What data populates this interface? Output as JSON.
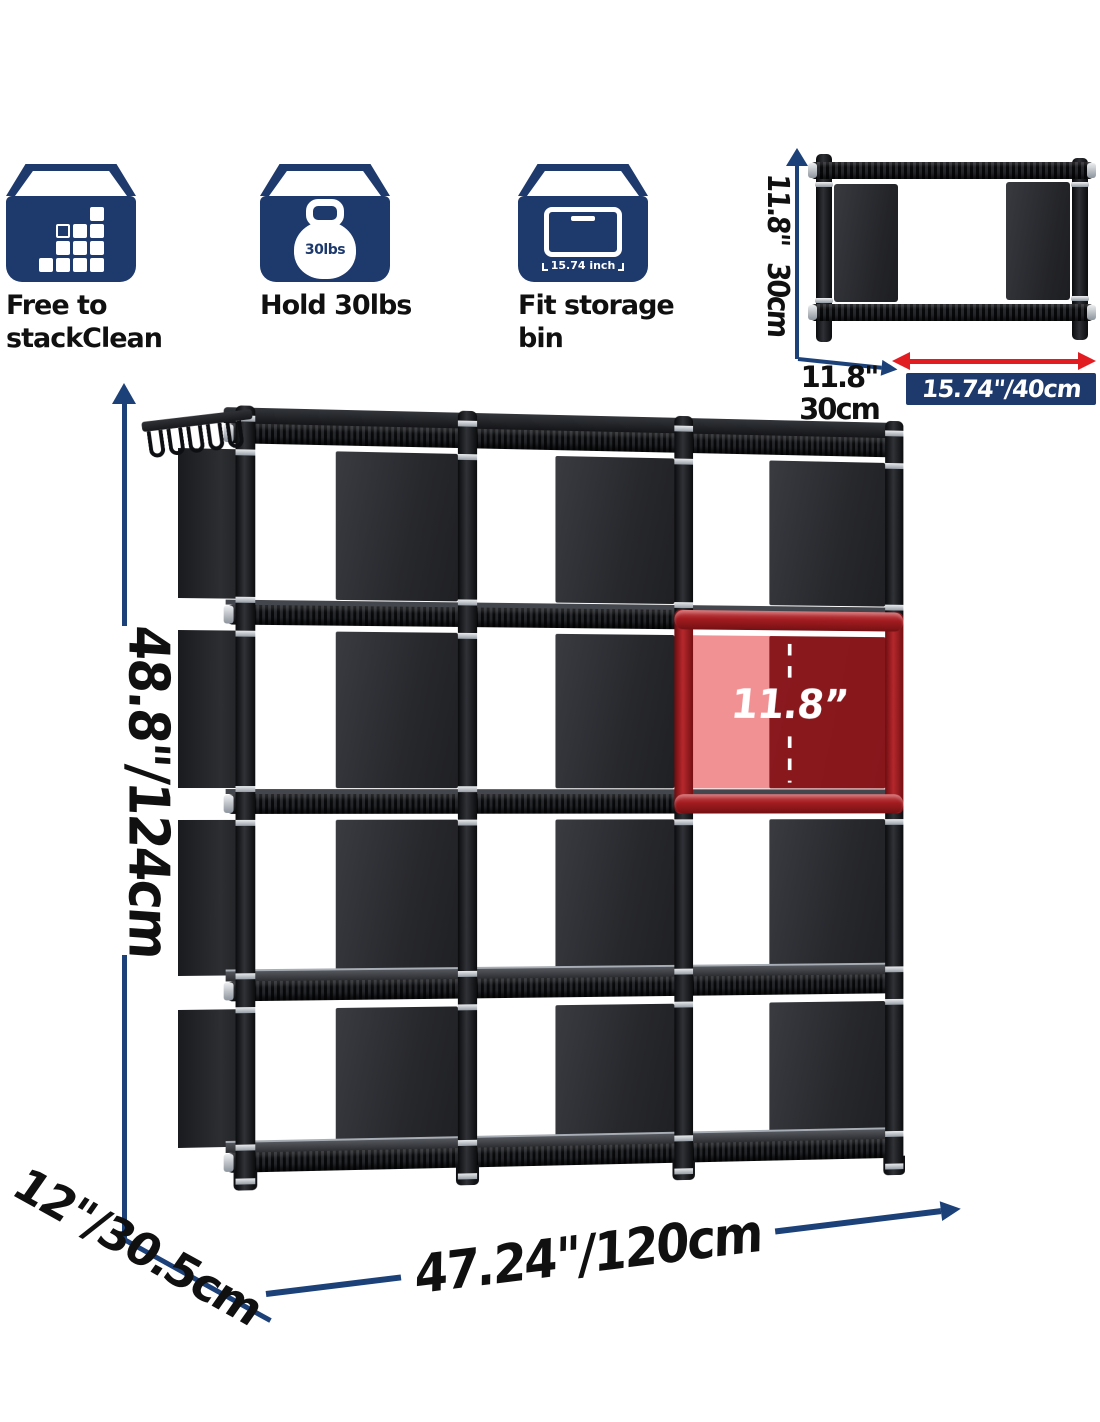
{
  "features": {
    "items": [
      {
        "icon": "stack-cubes-icon",
        "label_lines": [
          "Free to",
          "stackClean"
        ]
      },
      {
        "icon": "kettlebell-icon",
        "icon_text": "30lbs",
        "label_lines": [
          "Hold 30lbs"
        ]
      },
      {
        "icon": "storage-bin-icon",
        "icon_text": "15.74 inch",
        "label_lines": [
          "Fit storage",
          "bin"
        ]
      }
    ]
  },
  "mini_cube_diagram": {
    "height_label_parts": [
      "11.8\"",
      "30cm"
    ],
    "depth_label_lines": [
      "11.8\"",
      "30cm"
    ],
    "width_label": "15.74\"/40cm"
  },
  "main_diagram": {
    "height_label": "48.8\"/124cm",
    "cube_inner_height_label": "11.8”",
    "width_label": "47.24\"/120cm",
    "depth_label": "12\"/30.5cm"
  },
  "colors": {
    "navy": "#1e3a6d",
    "arrow_blue": "#1c4179",
    "red_arrow": "#e21d22",
    "highlight_red": "#a31b20",
    "label_text": "#101010"
  }
}
